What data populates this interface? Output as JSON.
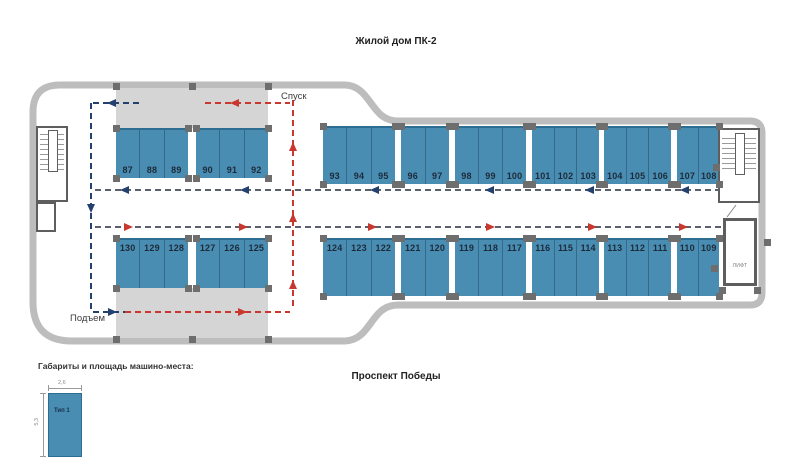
{
  "title": "Жилой дом ПК-2",
  "street_label": "Проспект Победы",
  "ramp_labels": {
    "descent": "Спуск",
    "ascent": "Подъем"
  },
  "elevator_label": "ЛИФТ",
  "legend": {
    "title": "Габариты и площадь машино-места:",
    "type_label": "Тип 1",
    "width_dim": "2,6",
    "depth_dim": "5,3"
  },
  "colors": {
    "stall": "#4a8db2",
    "stall_edge": "#2e6d92",
    "number": "#1c2b3a",
    "outline": "#bdbdbd",
    "ramp": "#d5d5d5",
    "column": "#6e6e6e",
    "gray": "#5a5f6b",
    "red": "#c9382e",
    "navy": "#24406e"
  },
  "plan": {
    "outline_path": "M 345 85 C 372 86 370 121 398 121 L 750 121 Q 762 121 762 133 L 762 293 Q 762 305 750 305 L 398 305 C 370 305 372 340 345 341 L 72 341 Q 33 341 33 302 L 33 112 Q 33 85 60 85 Z",
    "ramps": [
      {
        "x": 116,
        "y": 88,
        "w": 152,
        "h": 40
      },
      {
        "x": 116,
        "y": 288,
        "w": 152,
        "h": 50
      }
    ],
    "rows": [
      {
        "y": 128,
        "h": 50,
        "label_side": "bottom",
        "groups": [
          {
            "x": 116,
            "w": 72,
            "numbers": [
              "87",
              "88",
              "89"
            ]
          },
          {
            "x": 196,
            "w": 72,
            "numbers": [
              "90",
              "91",
              "92"
            ]
          }
        ]
      },
      {
        "y": 238,
        "h": 50,
        "label_side": "top",
        "groups": [
          {
            "x": 116,
            "w": 72,
            "numbers": [
              "130",
              "129",
              "128"
            ]
          },
          {
            "x": 196,
            "w": 72,
            "numbers": [
              "127",
              "126",
              "125"
            ]
          }
        ]
      },
      {
        "y": 126,
        "h": 58,
        "label_side": "bottom",
        "groups": [
          {
            "x": 323,
            "w": 72,
            "numbers": [
              "93",
              "94",
              "95"
            ]
          },
          {
            "x": 401,
            "w": 48,
            "numbers": [
              "96",
              "97"
            ]
          },
          {
            "x": 455,
            "w": 71,
            "numbers": [
              "98",
              "99",
              "100"
            ]
          },
          {
            "x": 532,
            "w": 67,
            "numbers": [
              "101",
              "102",
              "103"
            ]
          },
          {
            "x": 604,
            "w": 67,
            "numbers": [
              "104",
              "105",
              "106"
            ]
          },
          {
            "x": 677,
            "w": 42,
            "numbers": [
              "107",
              "108"
            ]
          }
        ]
      },
      {
        "y": 238,
        "h": 58,
        "label_side": "top",
        "groups": [
          {
            "x": 323,
            "w": 72,
            "numbers": [
              "124",
              "123",
              "122"
            ]
          },
          {
            "x": 401,
            "w": 48,
            "numbers": [
              "121",
              "120"
            ]
          },
          {
            "x": 455,
            "w": 71,
            "numbers": [
              "119",
              "118",
              "117"
            ]
          },
          {
            "x": 532,
            "w": 67,
            "numbers": [
              "116",
              "115",
              "114"
            ]
          },
          {
            "x": 604,
            "w": 67,
            "numbers": [
              "113",
              "112",
              "111"
            ]
          },
          {
            "x": 677,
            "w": 42,
            "numbers": [
              "110",
              "109"
            ]
          }
        ]
      }
    ],
    "dashes": [
      {
        "o": "h",
        "x": 95,
        "y": 190,
        "len": 662,
        "c": "gray"
      },
      {
        "o": "h",
        "x": 95,
        "y": 227,
        "len": 662,
        "c": "gray"
      },
      {
        "o": "v",
        "x": 293,
        "y": 100,
        "len": 210,
        "c": "red"
      },
      {
        "o": "v",
        "x": 91,
        "y": 103,
        "len": 210,
        "c": "navy"
      },
      {
        "o": "h",
        "x": 93,
        "y": 103,
        "len": 47,
        "c": "navy"
      },
      {
        "o": "h",
        "x": 205,
        "y": 103,
        "len": 85,
        "c": "red"
      },
      {
        "o": "h",
        "x": 93,
        "y": 312,
        "len": 32,
        "c": "navy"
      },
      {
        "o": "h",
        "x": 125,
        "y": 312,
        "len": 165,
        "c": "red"
      }
    ],
    "arrows": [
      {
        "x": 112,
        "y": 103,
        "dir": "left",
        "c": "navy"
      },
      {
        "x": 235,
        "y": 103,
        "dir": "left",
        "c": "red"
      },
      {
        "x": 125,
        "y": 190,
        "dir": "left",
        "c": "navy"
      },
      {
        "x": 245,
        "y": 190,
        "dir": "left",
        "c": "navy"
      },
      {
        "x": 375,
        "y": 190,
        "dir": "left",
        "c": "navy"
      },
      {
        "x": 490,
        "y": 190,
        "dir": "left",
        "c": "navy"
      },
      {
        "x": 590,
        "y": 190,
        "dir": "left",
        "c": "navy"
      },
      {
        "x": 685,
        "y": 190,
        "dir": "left",
        "c": "navy"
      },
      {
        "x": 128,
        "y": 227,
        "dir": "right",
        "c": "red"
      },
      {
        "x": 243,
        "y": 227,
        "dir": "right",
        "c": "red"
      },
      {
        "x": 372,
        "y": 227,
        "dir": "right",
        "c": "red"
      },
      {
        "x": 490,
        "y": 227,
        "dir": "right",
        "c": "red"
      },
      {
        "x": 592,
        "y": 227,
        "dir": "right",
        "c": "red"
      },
      {
        "x": 683,
        "y": 227,
        "dir": "right",
        "c": "red"
      },
      {
        "x": 293,
        "y": 147,
        "dir": "up",
        "c": "red"
      },
      {
        "x": 293,
        "y": 218,
        "dir": "up",
        "c": "red"
      },
      {
        "x": 293,
        "y": 285,
        "dir": "up",
        "c": "red"
      },
      {
        "x": 91,
        "y": 208,
        "dir": "down",
        "c": "navy"
      },
      {
        "x": 112,
        "y": 312,
        "dir": "right",
        "c": "navy"
      },
      {
        "x": 242,
        "y": 312,
        "dir": "right",
        "c": "red"
      }
    ],
    "columns_extra": [
      {
        "x": 116,
        "y": 86
      },
      {
        "x": 192,
        "y": 86
      },
      {
        "x": 268,
        "y": 86
      },
      {
        "x": 116,
        "y": 339
      },
      {
        "x": 192,
        "y": 339
      },
      {
        "x": 268,
        "y": 339
      },
      {
        "x": 716,
        "y": 167
      },
      {
        "x": 767,
        "y": 242
      },
      {
        "x": 714,
        "y": 268
      },
      {
        "x": 722,
        "y": 290
      },
      {
        "x": 757,
        "y": 290
      }
    ]
  }
}
